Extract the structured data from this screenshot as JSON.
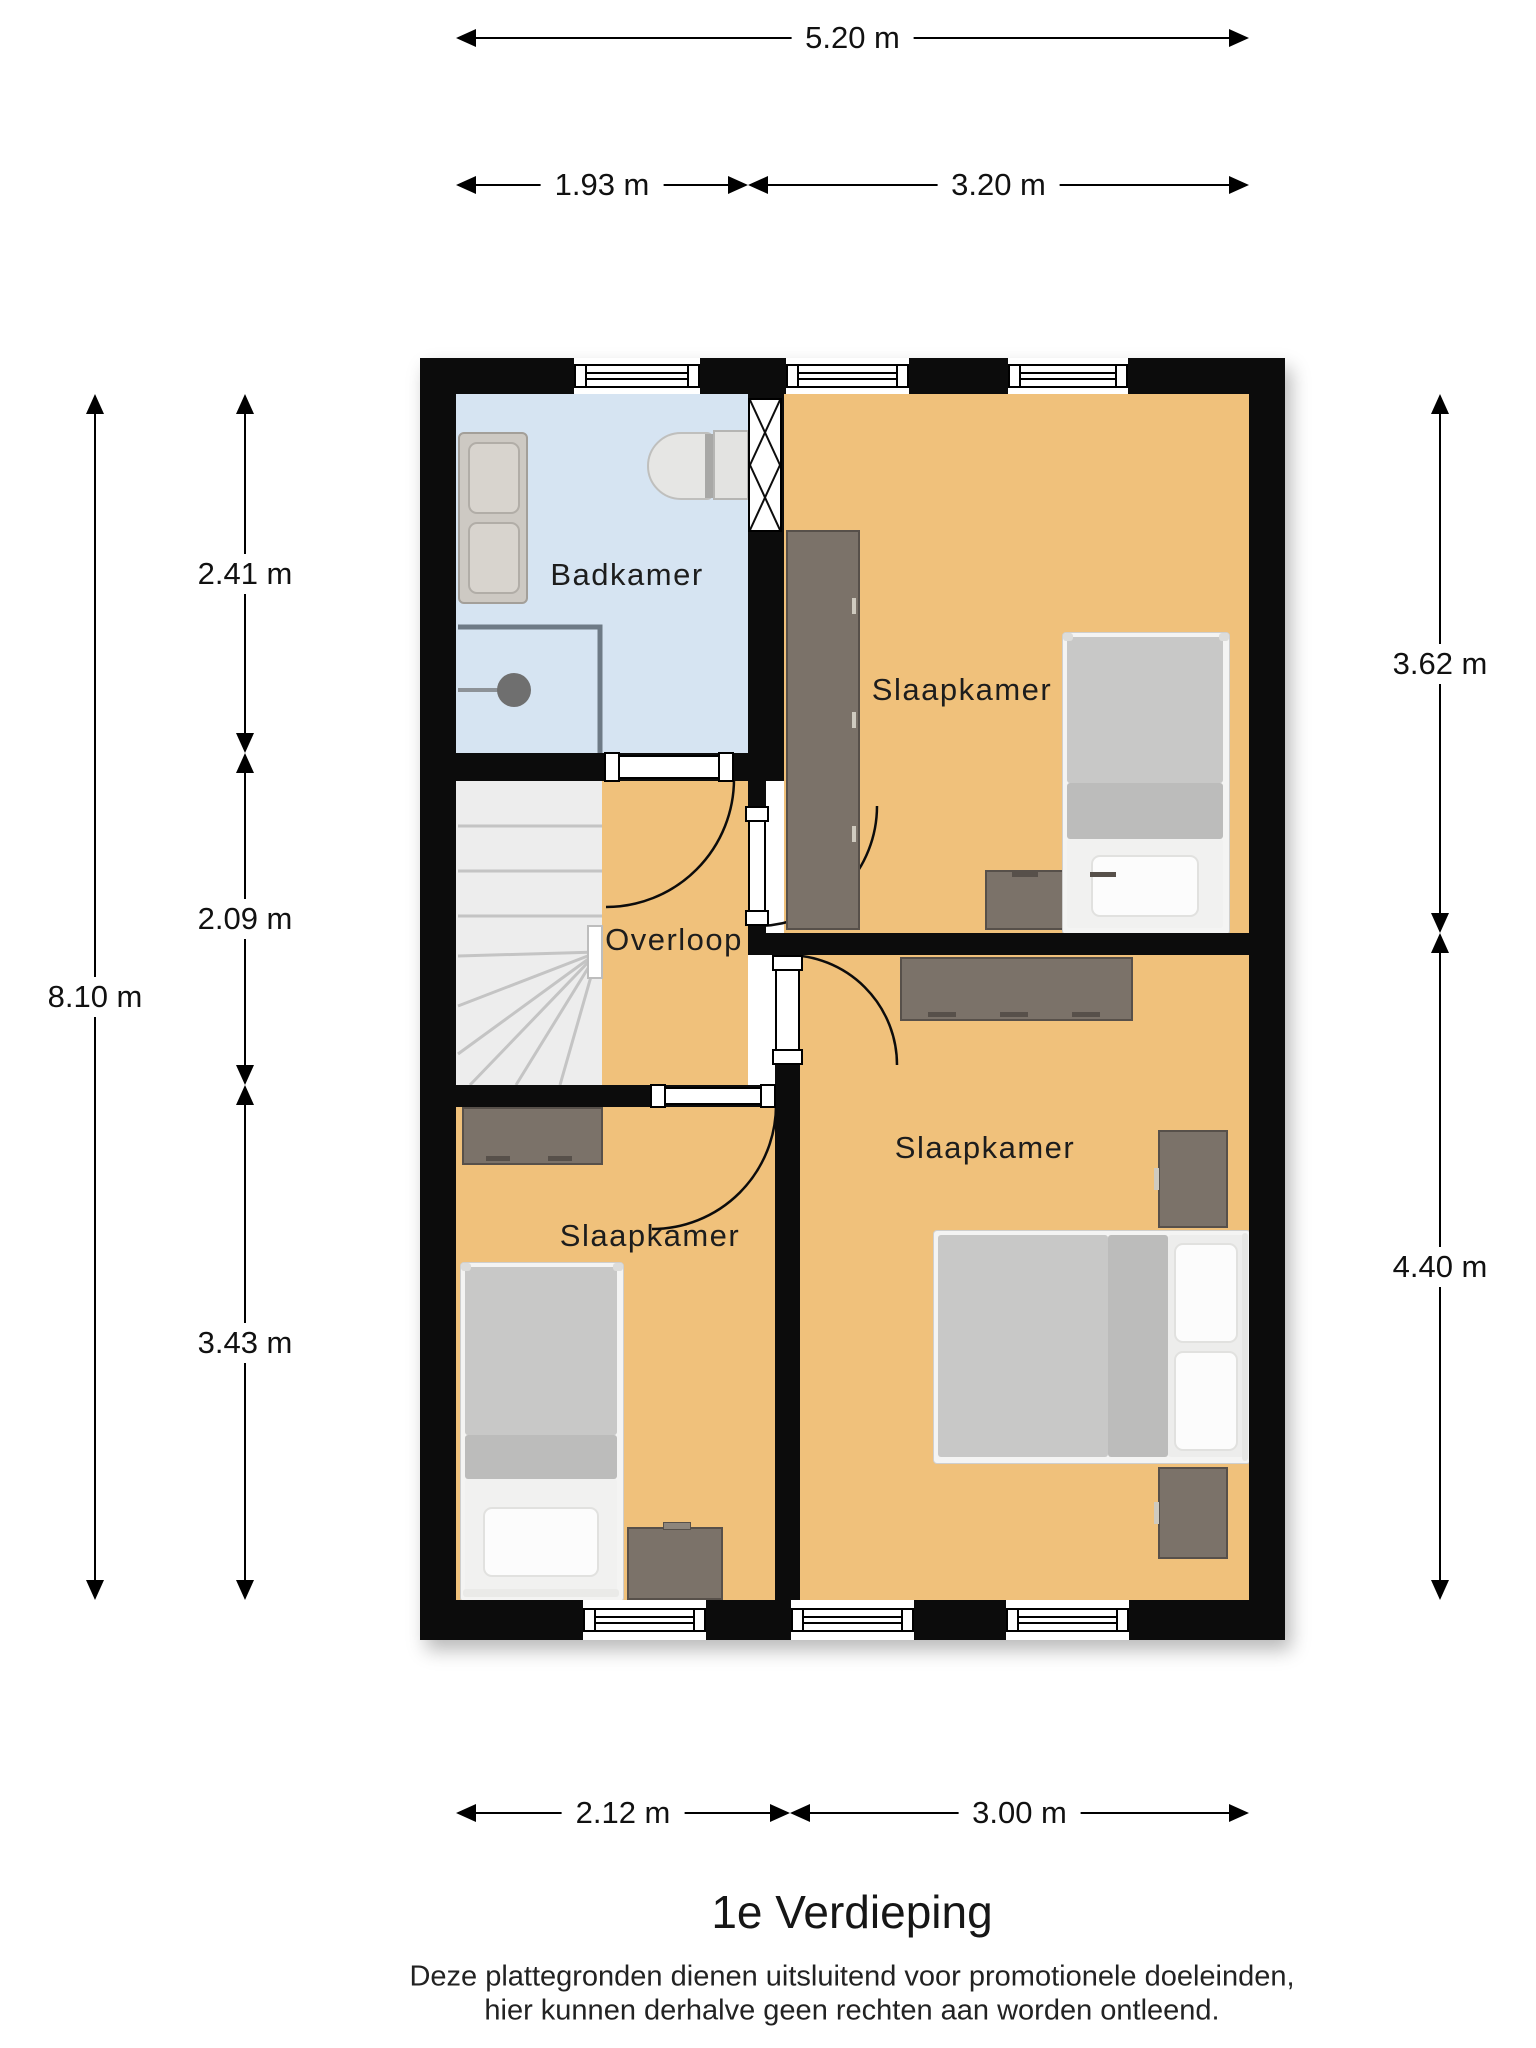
{
  "title": "1e Verdieping",
  "disclaimer": {
    "line1": "Deze plattegronden dienen uitsluitend voor promotionele doeleinden,",
    "line2": "hier kunnen derhalve geen rechten aan worden ontleend."
  },
  "rooms": {
    "badkamer": {
      "label": "Badkamer"
    },
    "overloop": {
      "label": "Overloop"
    },
    "slaapkamer_1": {
      "label": "Slaapkamer"
    },
    "slaapkamer_2": {
      "label": "Slaapkamer"
    },
    "slaapkamer_3": {
      "label": "Slaapkamer"
    }
  },
  "dimensions": {
    "top_total": "5.20 m",
    "top_left": "1.93 m",
    "top_right": "3.20 m",
    "left_total": "8.10 m",
    "left_seg1": "2.41 m",
    "left_seg2": "2.09 m",
    "left_seg3": "3.43 m",
    "right_seg1": "3.62 m",
    "right_seg2": "4.40 m",
    "bottom_left": "2.12 m",
    "bottom_right": "3.00 m"
  },
  "colors": {
    "wall": "#0c0c0c",
    "bathroom_floor": "#d6e4f2",
    "room_floor": "#f0c17b",
    "stairs_floor": "#ededed",
    "furniture_wood": "#7b7269",
    "furniture_wood_border": "#57504a",
    "bed_duvet": "#c8c8c7",
    "bed_fold": "#bcbcbb",
    "bed_sheet": "#f1f1f0",
    "fixture_gray": "#d8d4ce"
  }
}
